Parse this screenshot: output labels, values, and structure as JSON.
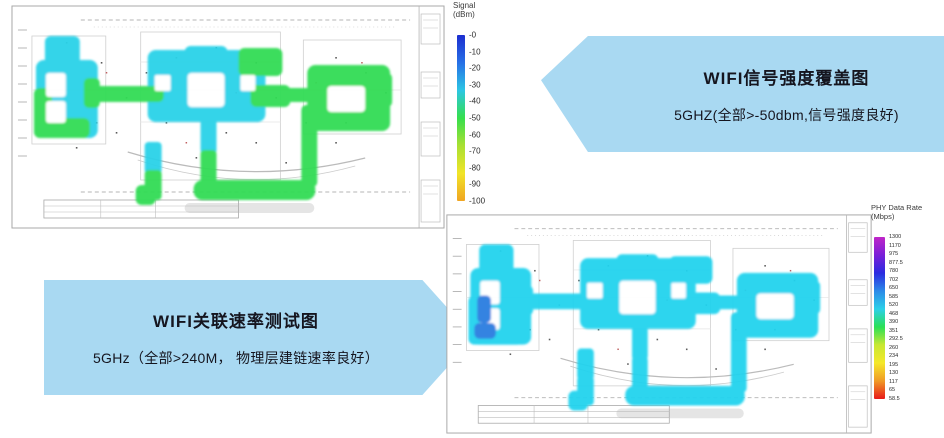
{
  "figure": {
    "background": "#ffffff"
  },
  "colors": {
    "callout_bg": "#a9d9f2",
    "callout_text": "#15151f",
    "heat_cyan": "#2bd2e8",
    "heat_green": "#31dc55",
    "heat_cyan_rate": "#22d3ee",
    "heat_blue": "#2b7de0",
    "signal_gradient": [
      "#1c2ed0",
      "#2770e6",
      "#2cc6e4",
      "#35df4d",
      "#a9e033",
      "#f1e428",
      "#f0a522"
    ],
    "rate_gradient": [
      "#c026c8",
      "#7a1fd8",
      "#2b2be0",
      "#2b8ae8",
      "#2bd0e8",
      "#2be055",
      "#c8e832",
      "#f5e82a",
      "#f09a26",
      "#e81a1a"
    ]
  },
  "maps": {
    "signal": {
      "name": "WiFi 5GHz signal strength coverage floor plan",
      "colorbar_title_line1": "Signal",
      "colorbar_title_line2": "(dBm)",
      "ticks": [
        "-0",
        "-10",
        "-20",
        "-30",
        "-40",
        "-50",
        "-60",
        "-70",
        "-80",
        "-90",
        "-100"
      ]
    },
    "rate": {
      "name": "WiFi 5GHz PHY data rate test floor plan",
      "colorbar_title_line1": "PHY Data Rate",
      "colorbar_title_line2": "(Mbps)",
      "ticks": [
        "1300",
        "1170",
        "975",
        "877.5",
        "780",
        "702",
        "650",
        "585",
        "520",
        "468",
        "390",
        "351",
        "292.5",
        "260",
        "234",
        "195",
        "130",
        "117",
        "65",
        "58.5"
      ],
      "ticks_estimated": true
    }
  },
  "callouts": {
    "signal": {
      "title": "WIFI信号强度覆盖图",
      "subtitle": "5GHZ(全部>-50dbm,信号强度良好)"
    },
    "rate": {
      "title": "WIFI关联速率测试图",
      "subtitle": "5GHz（全部>240M， 物理层建链速率良好）"
    }
  },
  "chart_data": [
    {
      "type": "heatmap",
      "title": "WIFI信号强度覆盖图",
      "subtitle": "5GHZ(全部>-50dbm,信号强度良好)",
      "band": "5GHZ",
      "colorbar": {
        "label": "Signal (dBm)",
        "orientation": "vertical",
        "position": "right",
        "ticks": [
          "-0",
          "-10",
          "-20",
          "-30",
          "-40",
          "-50",
          "-60",
          "-70",
          "-80",
          "-90",
          "-100"
        ],
        "range": [
          0,
          -100
        ],
        "gradient_top_to_bottom": [
          "blue",
          "cyan",
          "green",
          "yellow",
          "orange"
        ]
      },
      "observed_values": "All building wings read cyan-green, roughly -30 to -50 dBm; corridors/edges green (~-50 dBm); all areas > -50 dBm"
    },
    {
      "type": "heatmap",
      "title": "WIFI关联速率测试图",
      "subtitle": "5GHz（全部>240M， 物理层建链速率良好）",
      "band": "5GHz",
      "colorbar": {
        "label": "PHY Data Rate (Mbps)",
        "orientation": "vertical",
        "position": "right",
        "ticks": [
          "1300",
          "1170",
          "975",
          "877.5",
          "780",
          "702",
          "650",
          "585",
          "520",
          "468",
          "390",
          "351",
          "292.5",
          "260",
          "234",
          "195",
          "130",
          "117",
          "65",
          "58.5"
        ],
        "ticks_estimated": true,
        "range": [
          1300,
          0
        ],
        "gradient_top_to_bottom": [
          "magenta",
          "purple",
          "blue",
          "cyan",
          "green",
          "yellow",
          "orange",
          "red"
        ]
      },
      "observed_values": "Uniform cyan across the whole floor plan (~450-600 Mbps, all > 240M); small darker blue patch at left-wing west edge"
    }
  ]
}
